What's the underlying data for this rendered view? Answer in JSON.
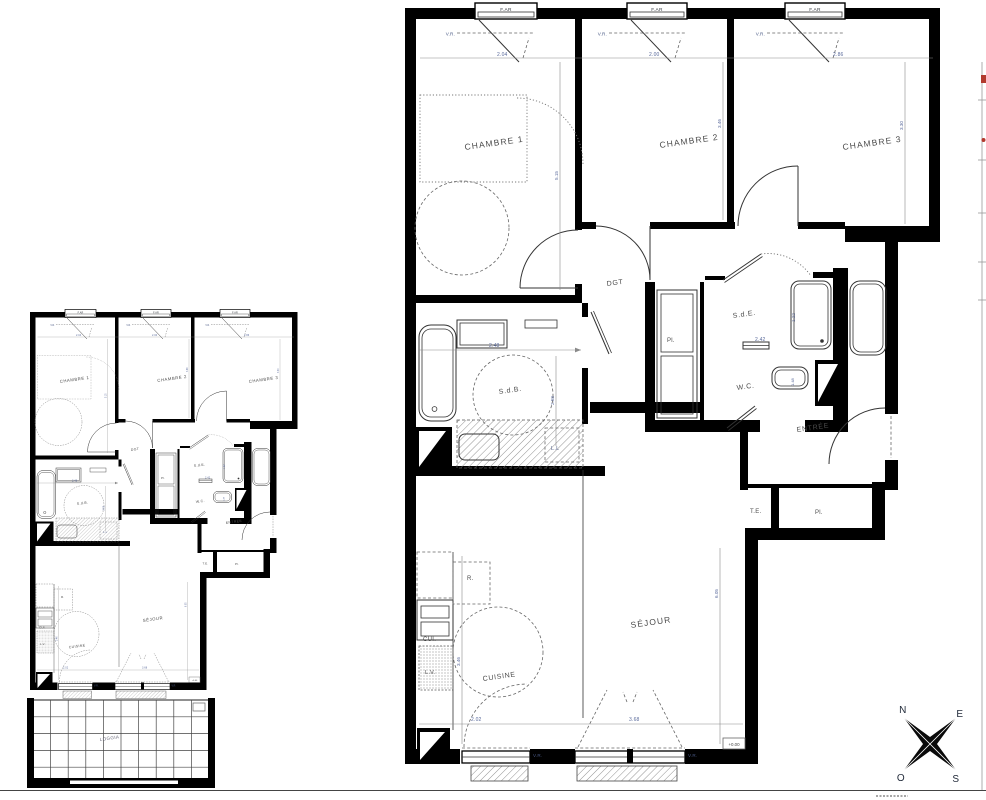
{
  "plan": {
    "rooms": {
      "chambre1": "CHAMBRE 1",
      "chambre2": "CHAMBRE 2",
      "chambre3": "CHAMBRE 3",
      "dgt": "DGT",
      "pl_hall": "Pl.",
      "sde": "S.d.E.",
      "wc": "W.C.",
      "sdb": "S.d.B.",
      "ll": "L.L",
      "entree": "ENTRÉE",
      "te": "T.E.",
      "pl_entry": "Pl.",
      "sejour": "SÉJOUR",
      "cuisine": "CUISINE",
      "cui": "CUI.",
      "lv": "L.V.",
      "r": "R."
    },
    "windows": {
      "far": "F.AR",
      "vr": "V.R."
    },
    "dims": {
      "w1": "2.04",
      "w2": "2.00",
      "w3": "2.86",
      "ch1_h": "5.15",
      "ch2_h": "3.46",
      "ch3_h": "3.30",
      "sde_w": "2.42",
      "shower_h": "1.22",
      "wc_b": "1.48",
      "sdb_w": "2.48",
      "sdb_h": "2.58",
      "sejour_h": "6.05",
      "kitchen_h": "3.46",
      "bw1": "2.02",
      "bw2": "3.68"
    },
    "level": "+0.00"
  },
  "small_plan": {
    "loggia": "LOGGIA"
  },
  "compass": {
    "n": "N",
    "e": "E",
    "s": "S",
    "o": "O"
  }
}
